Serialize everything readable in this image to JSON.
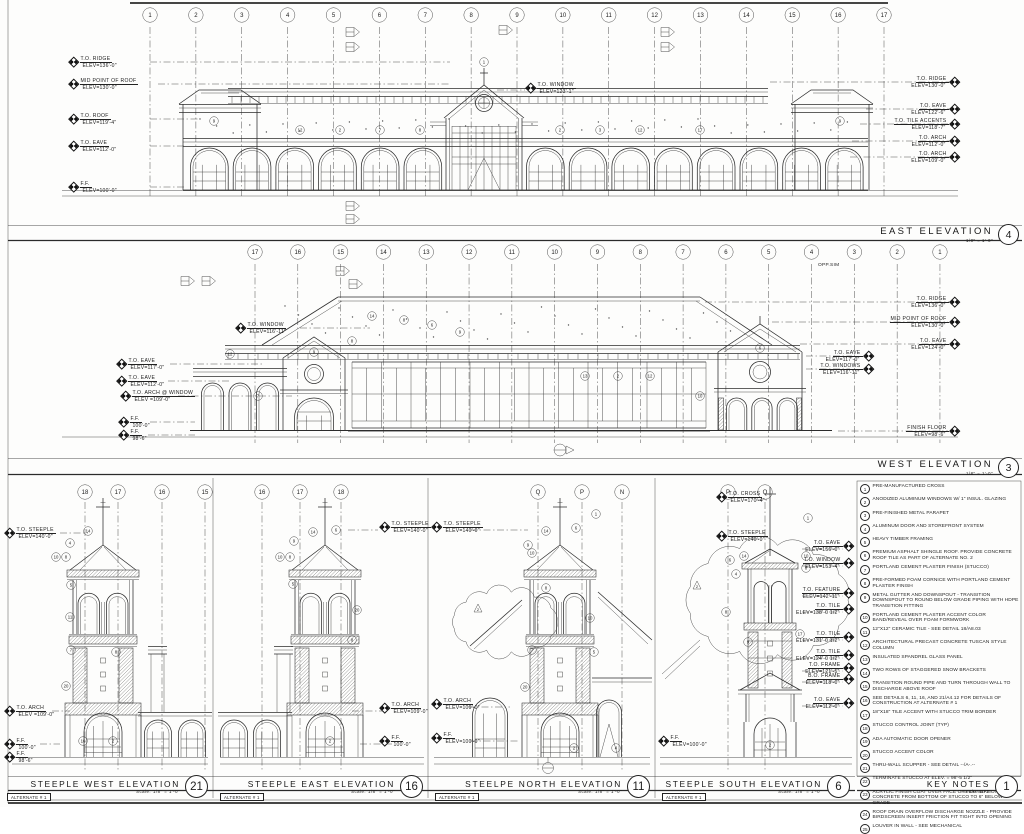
{
  "east": {
    "title": "EAST ELEVATION",
    "bubble": "4",
    "scale": "1/8\" = 1'-0\"",
    "grid": [
      "1",
      "2",
      "3",
      "4",
      "5",
      "6",
      "7",
      "8",
      "9",
      "10",
      "11",
      "12",
      "13",
      "14",
      "15",
      "16",
      "17"
    ],
    "labels_left": [
      {
        "name": "T.O. RIDGE",
        "elev": "ELEV=136'-0\""
      },
      {
        "name": "MID POINT OF ROOF",
        "elev": "ELEV=130'-0\""
      },
      {
        "name": "T.O. ROOF",
        "elev": "ELEV=119'-4\""
      },
      {
        "name": "T.O. EAVE",
        "elev": "ELEV=112'-0\""
      },
      {
        "name": "F.F.",
        "elev": "ELEV=100'-0\""
      }
    ],
    "labels_right": [
      {
        "name": "T.O. RIDGE",
        "elev": "ELEV=130'-0\""
      },
      {
        "name": "T.O. EAVE",
        "elev": "ELEV=122'-6\""
      },
      {
        "name": "T.O. TILE ACCENTS",
        "elev": "ELEV=118'-7\""
      },
      {
        "name": "T.O. ARCH",
        "elev": "ELEV=112'-0\""
      },
      {
        "name": "T.O. ARCH",
        "elev": "ELEV=109'-0\""
      }
    ],
    "labels_mid": [
      {
        "name": "T.O. WINDOW",
        "elev": "ELEV=123'-1\""
      }
    ],
    "keynote_refs": [
      "1",
      "9",
      "12",
      "2",
      "7",
      "8",
      "2",
      "3",
      "12",
      "17",
      "9"
    ]
  },
  "west": {
    "title": "WEST ELEVATION",
    "bubble": "3",
    "scale": "1/8\" = 1'-0\"",
    "opp_sim": "OPP.SIM",
    "grid": [
      "17",
      "16",
      "15",
      "14",
      "13",
      "12",
      "11",
      "10",
      "9",
      "8",
      "7",
      "6",
      "5",
      "4",
      "3",
      "2",
      "1"
    ],
    "labels_left": [
      {
        "name": "T.O. WINDOW",
        "elev": "ELEV=116'-11\""
      },
      {
        "name": "T.O. EAVE",
        "elev": "ELEV=117'-0\""
      },
      {
        "name": "T.O. EAVE",
        "elev": "ELEV=112'-0\""
      },
      {
        "name": "T.O. ARCH @ WINDOW",
        "elev": "ELEV =109'-0\""
      },
      {
        "name": "F.F.",
        "elev": "100'-0\""
      },
      {
        "name": "F.F.",
        "elev": "98'-6\""
      }
    ],
    "labels_right": [
      {
        "name": "T.O. RIDGE",
        "elev": "ELEV=136'-0\""
      },
      {
        "name": "MID POINT OF ROOF",
        "elev": "ELEV=130'-0\""
      },
      {
        "name": "T.O. EAVE",
        "elev": "ELEV=124'-0\""
      },
      {
        "name": "T.O. EAVE",
        "elev": "ELEV=117'-0\""
      },
      {
        "name": "T.O. WINDOWS",
        "elev": "ELEV=116'-11\""
      },
      {
        "name": "FINISH FLOOR",
        "elev": "ELEV=98'-6\""
      }
    ],
    "keynote_refs": [
      "14",
      "8",
      "6",
      "9",
      "12",
      "7",
      "8",
      "13",
      "2",
      "12",
      "6",
      "10",
      "9"
    ]
  },
  "steeples": [
    {
      "title": "STEEPLE WEST ELEVATION",
      "bubble": "21",
      "scale_prefix": "Scale:",
      "scale": "1/8\" = 1'-0\"",
      "alternate": "ALTERNATE # 1",
      "grid": [
        "18",
        "17",
        "16",
        "15"
      ],
      "labels_left": [
        {
          "name": "T.O. STEEPLE",
          "elev": "ELEV=140'-0\""
        },
        {
          "name": "T.O. ARCH",
          "elev": "ELEV =109'-0\""
        },
        {
          "name": "F.F.",
          "elev": "100'-0\""
        },
        {
          "name": "F.F.",
          "elev": "98'-6\""
        }
      ],
      "labels_right": [],
      "keynote_refs": [
        "14",
        "4",
        "10",
        "8",
        "5",
        "11",
        "7",
        "8",
        "20",
        "2",
        "10"
      ]
    },
    {
      "title": "STEEPLE EAST ELEVATION",
      "bubble": "16",
      "scale_prefix": "Scale:",
      "scale": "1/8\" = 1'-0\"",
      "alternate": "ALTERNATE # 1",
      "grid": [
        "16",
        "17",
        "18"
      ],
      "labels_left": [
        {
          "name": "T.O. STEEPLE",
          "elev": "ELEV=140'-0\""
        },
        {
          "name": "T.O. ARCH",
          "elev": "ELEV=109'-0\""
        },
        {
          "name": "F.F.",
          "elev": "100'-0\""
        }
      ],
      "labels_right": [],
      "keynote_refs": [
        "14",
        "6",
        "9",
        "10",
        "8",
        "5",
        "8",
        "20",
        "2"
      ]
    },
    {
      "title": "STEELPE NORTH ELEVATION",
      "bubble": "11",
      "scale_prefix": "Scale:",
      "scale": "1/8\" = 1'-0\"",
      "alternate": "ALTERNATE # 1",
      "grid": [
        "Q",
        "P",
        "N"
      ],
      "revision_tag": "2",
      "labels_left": [
        {
          "name": "T.O. STEEPLE",
          "elev": "ELEV=140'-0\""
        },
        {
          "name": "T.O. ARCH",
          "elev": "ELEV=109'-0\""
        },
        {
          "name": "F.F.",
          "elev": "ELEV=100'-0\""
        }
      ],
      "labels_right": [],
      "keynote_refs": [
        "1",
        "14",
        "6",
        "9",
        "10",
        "8",
        "10",
        "7",
        "5",
        "20",
        "2",
        "4"
      ]
    },
    {
      "title": "STEEPLE SOUTH ELEVATION",
      "bubble": "6",
      "scale_prefix": "Scale:",
      "scale": "1/8\" = 1'-0\"",
      "alternate": "ALTERNATE # 1",
      "grid": [
        "P",
        "Q"
      ],
      "revision_tag": "2",
      "labels_left": [
        {
          "name": "T.O. CROSS",
          "elev": "ELEV=170'-4\""
        },
        {
          "name": "T.O. STEEPLE",
          "elev": "ELEV=140'-0\""
        },
        {
          "name": "F.F.",
          "elev": "ELEV=100'-0\""
        }
      ],
      "labels_right": [
        {
          "name": "T.O. EAVE",
          "elev": "ELEV=156'-0\""
        },
        {
          "name": "T.O. WINDOW",
          "elev": "ELEV=153'-4\""
        },
        {
          "name": "T.O. FEATURE",
          "elev": "ELEV=142'-11\""
        },
        {
          "name": "T.O. TILE",
          "elev": "ELEV=138'-0 1/2\""
        },
        {
          "name": "T.O. TILE",
          "elev": "ELEV=131'-0 1/2\""
        },
        {
          "name": "T.O. TILE",
          "elev": "ELEV=124'-0 1/2\""
        },
        {
          "name": "T.O. FRAME",
          "elev": "ELEV=121'-5\""
        },
        {
          "name": "B.O. FRAME",
          "elev": "ELEV=118'-0\""
        },
        {
          "name": "T.O. EAVE",
          "elev": "ELEV=112'-0\""
        }
      ],
      "keynote_refs": [
        "1",
        "14",
        "6",
        "10",
        "8",
        "4",
        "8",
        "9",
        "17",
        "2"
      ]
    }
  ],
  "key_notes": {
    "title": "KEY NOTES",
    "bubble": "1",
    "scale_prefix": "Scale:",
    "scale": "NTS",
    "items": [
      {
        "num": "1",
        "text": "PRE-MANUFACTURED CROSS"
      },
      {
        "num": "2",
        "text": "ANODIZED ALUMINUM WINDOWS W/ 1\" INSUL. GLAZING"
      },
      {
        "num": "3",
        "text": "PRE-FINISHED METAL PARAPET"
      },
      {
        "num": "4",
        "text": "ALUMINUM DOOR AND STOREFRONT SYSTEM"
      },
      {
        "num": "5",
        "text": "HEAVY TIMBER FRAMING"
      },
      {
        "num": "6",
        "text": "PREMIUM ASPHALT SHINGLE ROOF.  PROVIDE CONCRETE ROOF TILE AS PART OF ALTERNATE NO. 2"
      },
      {
        "num": "7",
        "text": "PORTLAND CEMENT PLASTER FINISH (STUCCO)"
      },
      {
        "num": "8",
        "text": "PRE-FORMED FOAM CORNICE WITH PORTLAND CEMENT PLASTER FINISH"
      },
      {
        "num": "9",
        "text": "METAL GUTTER AND DOWNSPOUT - TRANSITION DOWNSPOUT TO ROUND BELOW GRADE PIPING WITH HDPE TRANSITION FITTING"
      },
      {
        "num": "10",
        "text": "PORTLAND CEMENT PLASTER ACCENT COLOR BAND/REVEAL OVER FOAM FORMWORK"
      },
      {
        "num": "11",
        "text": "12\"X12\" CERAMIC TILE - SEE DETAIL 18/A8.03"
      },
      {
        "num": "12",
        "text": "ARCHITECTURAL PRECAST CONCRETE TUSCAN STYLE COLUMN"
      },
      {
        "num": "13",
        "text": "INSULATED SPANDREL GLASS PANEL"
      },
      {
        "num": "14",
        "text": "TWO ROWS OF STAGGERED SNOW BRACKETS"
      },
      {
        "num": "15",
        "text": "TRANSITION ROUND PIPE AND TURN THROUGH WALL TO DISCHARGE ABOVE ROOF"
      },
      {
        "num": "16",
        "text": "SEE DETAILS 6, 11, 16, AND 21/A4.12 FOR DETAILS OF CONSTRUCTION AT ALTERNATE # 1"
      },
      {
        "num": "17",
        "text": "18\"X18\" TILE ACCENT WITH STUCCO TRIM BORDER"
      },
      {
        "num": "18",
        "text": "STUCCO CONTROL JOINT (TYP)"
      },
      {
        "num": "19",
        "text": "ADA AUTOMATIC DOOR OPENER"
      },
      {
        "num": "20",
        "text": "STUCCO ACCENT COLOR"
      },
      {
        "num": "21",
        "text": "THRU-WALL SCUPPER - SEE DETAIL --/A-.--"
      },
      {
        "num": "22",
        "text": "TERMINATE STUCCO AT ELEV. = 98'-5 1/2\""
      },
      {
        "num": "23",
        "text": "ACRYLIC FINISH COAT OVER FACE OF FOUNDATION CONCRETE FROM BOTTOM OF STUCCO TO 6\" BELOW GRADE"
      },
      {
        "num": "24",
        "text": "ROOF DRAIN OVERFLOW DISCHARGE NOZZLE - PROVIDE BIRDSCREEN INSERT FRICTION FIT TIGHT INTO OPENING"
      },
      {
        "num": "25",
        "text": "LOUVER IN WALL - SEE MECHANICAL"
      }
    ]
  }
}
